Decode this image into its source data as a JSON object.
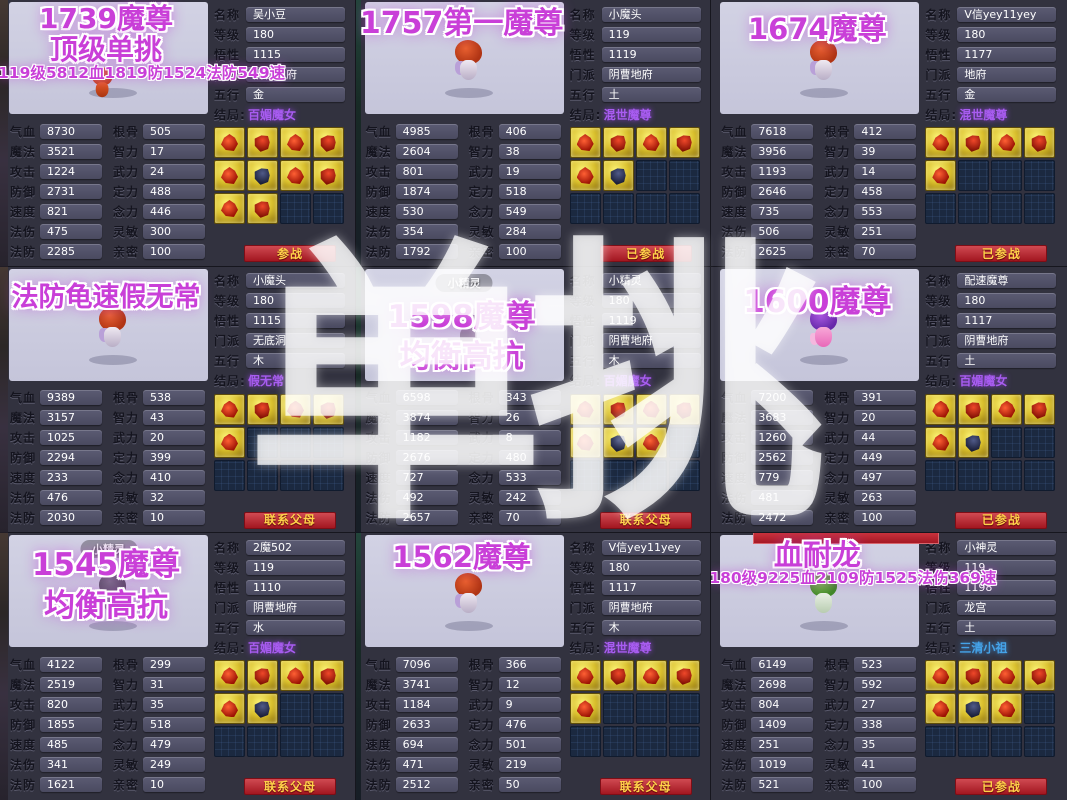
{
  "watermark": "单挑",
  "labels": {
    "info": [
      "名称",
      "等级",
      "悟性",
      "门派",
      "五行",
      "结局:"
    ],
    "stats_left": [
      "气血",
      "魔法",
      "攻击",
      "防御",
      "速度",
      "法伤",
      "法防"
    ],
    "stats_right": [
      "根骨",
      "智力",
      "武力",
      "定力",
      "念力",
      "灵敏",
      "亲密"
    ]
  },
  "colors": {
    "title_magenta": "#c93fd8",
    "ending_purple": "#a85cf0",
    "ending_blue": "#45a3e8",
    "button_red": "#a21620",
    "button_text_gold": "#ffd24a",
    "skill_gold": "#d9bf2c",
    "portrait_lavender": "#c9c9dd",
    "panel_dark": "#32323f"
  },
  "cells": [
    {
      "title_lines": [
        "1739魔尊",
        "顶级单挑"
      ],
      "subtitle": "119级5812血1819防1524法防549速",
      "portrait_label": "",
      "info": {
        "name": "吴小豆",
        "level": "180",
        "aptitude": "1115",
        "school": "阴曹地府",
        "element": "金",
        "ending": "百媚魔女"
      },
      "ending_color": "purple",
      "stats_left": [
        "8730",
        "3521",
        "1224",
        "2731",
        "821",
        "475",
        "2285"
      ],
      "stats_right": [
        "505",
        "17",
        "24",
        "488",
        "446",
        "300",
        "100"
      ],
      "skills_filled": 10,
      "button": "参战",
      "pet": "orange",
      "top_partial": false
    },
    {
      "title_lines": [
        "1757第一魔尊"
      ],
      "subtitle": "",
      "portrait_label": "",
      "info": {
        "name": "小魔头",
        "level": "119",
        "aptitude": "1119",
        "school": "阴曹地府",
        "element": "土",
        "ending": "混世魔尊"
      },
      "ending_color": "purple",
      "stats_left": [
        "4985",
        "2604",
        "801",
        "1874",
        "530",
        "354",
        "1792"
      ],
      "stats_right": [
        "406",
        "38",
        "19",
        "518",
        "549",
        "284",
        "100"
      ],
      "skills_filled": 6,
      "button": "已参战",
      "pet": "red",
      "top_partial": false
    },
    {
      "title_lines": [
        "1674魔尊"
      ],
      "subtitle": "",
      "portrait_label": "",
      "info": {
        "name": "V信yey11yey",
        "level": "180",
        "aptitude": "1177",
        "school": "地府",
        "element": "金",
        "ending": "混世魔尊"
      },
      "ending_color": "purple",
      "stats_left": [
        "7618",
        "3956",
        "1193",
        "2646",
        "735",
        "506",
        "2625"
      ],
      "stats_right": [
        "412",
        "39",
        "14",
        "458",
        "553",
        "251",
        "70"
      ],
      "skills_filled": 5,
      "button": "已参战",
      "pet": "red",
      "top_partial": false
    },
    {
      "title_lines": [
        "法防龟速假无常"
      ],
      "subtitle": "",
      "portrait_label": "",
      "info": {
        "name": "小魔头",
        "level": "180",
        "aptitude": "1115",
        "school": "无底洞",
        "element": "木",
        "ending": "假无常"
      },
      "ending_color": "purple",
      "stats_left": [
        "9389",
        "3157",
        "1025",
        "2294",
        "233",
        "476",
        "2030"
      ],
      "stats_right": [
        "538",
        "43",
        "20",
        "399",
        "410",
        "32",
        "10"
      ],
      "skills_filled": 5,
      "button": "联系父母",
      "pet": "red",
      "top_partial": false
    },
    {
      "title_lines": [
        "1598魔尊",
        "均衡高抗"
      ],
      "subtitle": "",
      "portrait_label": "小精灵",
      "info": {
        "name": "小精灵",
        "level": "180",
        "aptitude": "1119",
        "school": "阴曹地府",
        "element": "木",
        "ending": "百媚魔女"
      },
      "ending_color": "purple",
      "stats_left": [
        "6598",
        "3874",
        "1182",
        "2676",
        "727",
        "492",
        "2657"
      ],
      "stats_right": [
        "343",
        "26",
        "8",
        "480",
        "533",
        "242",
        "70"
      ],
      "skills_filled": 7,
      "button": "联系父母",
      "pet": "dark",
      "top_partial": false
    },
    {
      "title_lines": [
        "1600魔尊"
      ],
      "subtitle": "",
      "portrait_label": "",
      "info": {
        "name": "配速魔尊",
        "level": "180",
        "aptitude": "1117",
        "school": "阴曹地府",
        "element": "土",
        "ending": "百媚魔女"
      },
      "ending_color": "purple",
      "stats_left": [
        "7200",
        "3683",
        "1260",
        "2562",
        "779",
        "481",
        "2472"
      ],
      "stats_right": [
        "391",
        "20",
        "44",
        "449",
        "497",
        "263",
        "100"
      ],
      "skills_filled": 6,
      "button": "已参战",
      "pet": "purple",
      "top_partial": false
    },
    {
      "title_lines": [
        "1545魔尊",
        "均衡高抗"
      ],
      "subtitle": "",
      "portrait_label": "小精灵",
      "info": {
        "name": "2魔502",
        "level": "119",
        "aptitude": "1110",
        "school": "阴曹地府",
        "element": "水",
        "ending": "百媚魔女"
      },
      "ending_color": "purple",
      "stats_left": [
        "4122",
        "2519",
        "820",
        "1855",
        "485",
        "341",
        "1621"
      ],
      "stats_right": [
        "299",
        "31",
        "35",
        "518",
        "479",
        "249",
        "10"
      ],
      "skills_filled": 6,
      "button": "联系父母",
      "pet": "dark",
      "top_partial": false
    },
    {
      "title_lines": [
        "1562魔尊"
      ],
      "subtitle": "",
      "portrait_label": "",
      "info": {
        "name": "V信yey11yey",
        "level": "180",
        "aptitude": "1117",
        "school": "阴曹地府",
        "element": "木",
        "ending": "混世魔尊"
      },
      "ending_color": "purple",
      "stats_left": [
        "7096",
        "3741",
        "1184",
        "2633",
        "694",
        "471",
        "2512"
      ],
      "stats_right": [
        "366",
        "12",
        "9",
        "476",
        "501",
        "219",
        "50"
      ],
      "skills_filled": 5,
      "button": "联系父母",
      "pet": "red",
      "top_partial": false
    },
    {
      "title_lines": [
        "血耐龙"
      ],
      "subtitle": "180级9225血2109防1525法伤369速",
      "portrait_label": "",
      "info": {
        "name": "小神灵",
        "level": "119",
        "aptitude": "1198",
        "school": "龙宫",
        "element": "土",
        "ending": "三清小祖"
      },
      "ending_color": "blue",
      "stats_left": [
        "6149",
        "2698",
        "804",
        "1409",
        "251",
        "1019",
        "521"
      ],
      "stats_right": [
        "523",
        "592",
        "27",
        "338",
        "35",
        "41",
        "100"
      ],
      "skills_filled": 7,
      "button": "已参战",
      "pet": "green",
      "top_partial": true
    }
  ]
}
